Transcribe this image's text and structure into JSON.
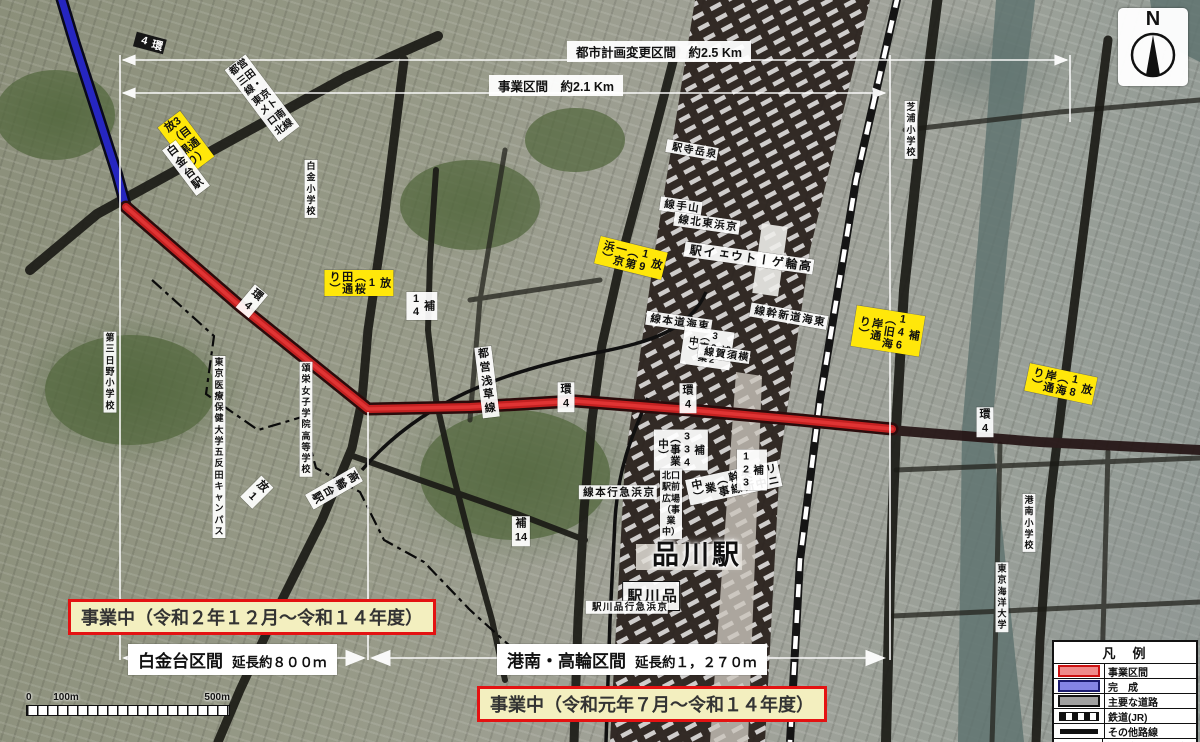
{
  "dimensions": {
    "outer": "都市計画変更区間　約2.5 Km",
    "inner": "事業区間　約2.1 Km"
  },
  "banners": {
    "shirokanedai": "事業中（令和２年１２月～令和１４年度）",
    "konan_takanawa": "事業中（令和元年７月～令和１４年度）"
  },
  "sections": {
    "shirokanedai": {
      "name": "白金台区間",
      "length": "延長約８００ｍ"
    },
    "konan_takanawa": {
      "name": "港南・高輪区間",
      "length": "延長約１，２７０ｍ"
    }
  },
  "compass": {
    "label": "N"
  },
  "scalebar": {
    "start": "0",
    "mid": "100m",
    "end": "500m"
  },
  "legend": {
    "title": "凡　例",
    "items": [
      {
        "id": "jigyo-kukan",
        "label": "事業区間",
        "swatch": "red-bar",
        "color": "#ef8a8a"
      },
      {
        "id": "kansei",
        "label": "完　成",
        "swatch": "blue-bar",
        "color": "#8585e5"
      },
      {
        "id": "shuyo-doro",
        "label": "主要な道路",
        "swatch": "gray-bar",
        "color": "#a0a0a0"
      },
      {
        "id": "tetsudo-jr",
        "label": "鉄道(JR)",
        "swatch": "railway",
        "color": "#111111"
      },
      {
        "id": "sonota-rosen",
        "label": "その他路線",
        "swatch": "thick-line",
        "color": "#111111"
      },
      {
        "id": "gyosei-kyokai",
        "label": "行政境界（都県境）",
        "swatch": "dash-dot",
        "color": "#111111"
      }
    ]
  },
  "map_labels": [
    {
      "id": "kan4-blue",
      "text": "環4"
    },
    {
      "id": "ho3-meguro",
      "text": "放3（目黒通り）"
    },
    {
      "id": "shirokanedai-sta",
      "text": "白金台駅"
    },
    {
      "id": "mita-nanboku",
      "text": "都営三田線・\n東京メトロ南北線"
    },
    {
      "id": "shirokane-es",
      "text": "白金\n小学校"
    },
    {
      "id": "ho1-sakurada",
      "text": "放1（桜田通り）"
    },
    {
      "id": "kan4-diag",
      "text": "環4"
    },
    {
      "id": "ho14-v",
      "text": "補14"
    },
    {
      "id": "dai3hino-es",
      "text": "第三日野\n小学校"
    },
    {
      "id": "iryo-univ",
      "text": "東京医療保健大学\n五反田キャンパス"
    },
    {
      "id": "shoei-hs",
      "text": "頌栄女子学院\n高等学校"
    },
    {
      "id": "takanawadai-sta",
      "text": "高輪台駅"
    },
    {
      "id": "ho1-sm",
      "text": "放1"
    },
    {
      "id": "asakusa-line",
      "text": "都営浅草線"
    },
    {
      "id": "kan4-a",
      "text": "環4"
    },
    {
      "id": "kan4-b",
      "text": "環4"
    },
    {
      "id": "kan4-c",
      "text": "環4"
    },
    {
      "id": "ho14-h",
      "text": "補14"
    },
    {
      "id": "ho19-keihin",
      "text": "放19（第一京浜）"
    },
    {
      "id": "sengakuji-sta",
      "text": "泉岳寺駅"
    },
    {
      "id": "yamanote-line",
      "text": "山手線"
    },
    {
      "id": "keihintohoku-line",
      "text": "京浜東北線"
    },
    {
      "id": "takanawa-gw-sta",
      "text": "高輪ゲートウェイ駅"
    },
    {
      "id": "tokaido-line",
      "text": "東海道本線"
    },
    {
      "id": "ho332",
      "text": "補332（事業中）"
    },
    {
      "id": "yokosuka-line",
      "text": "横須賀線"
    },
    {
      "id": "shinkansen",
      "text": "東海道新幹線"
    },
    {
      "id": "ho146",
      "text": "補146（旧海岸通り）"
    },
    {
      "id": "ho18",
      "text": "放18（海岸通り）"
    },
    {
      "id": "shibaura-es",
      "text": "芝浦\n小学校"
    },
    {
      "id": "konan-es",
      "text": "港南\n小学校"
    },
    {
      "id": "kaiyo-univ",
      "text": "東京海洋大学"
    },
    {
      "id": "rinia",
      "text": "リニア中央新幹線\n（事業中）"
    },
    {
      "id": "ho123",
      "text": "補123"
    },
    {
      "id": "ho334",
      "text": "補334\n（事業中）"
    },
    {
      "id": "kitaguchi-plaza",
      "text": "北口駅前広場\n（事業中）"
    },
    {
      "id": "shinagawa-sta-big",
      "text": "品川駅"
    },
    {
      "id": "shinagawa-sta-v",
      "text": "品川駅"
    },
    {
      "id": "keikyu-shinagawa-sta",
      "text": "京浜急行品川駅"
    },
    {
      "id": "keikyu-line",
      "text": "京浜急行本線"
    }
  ]
}
